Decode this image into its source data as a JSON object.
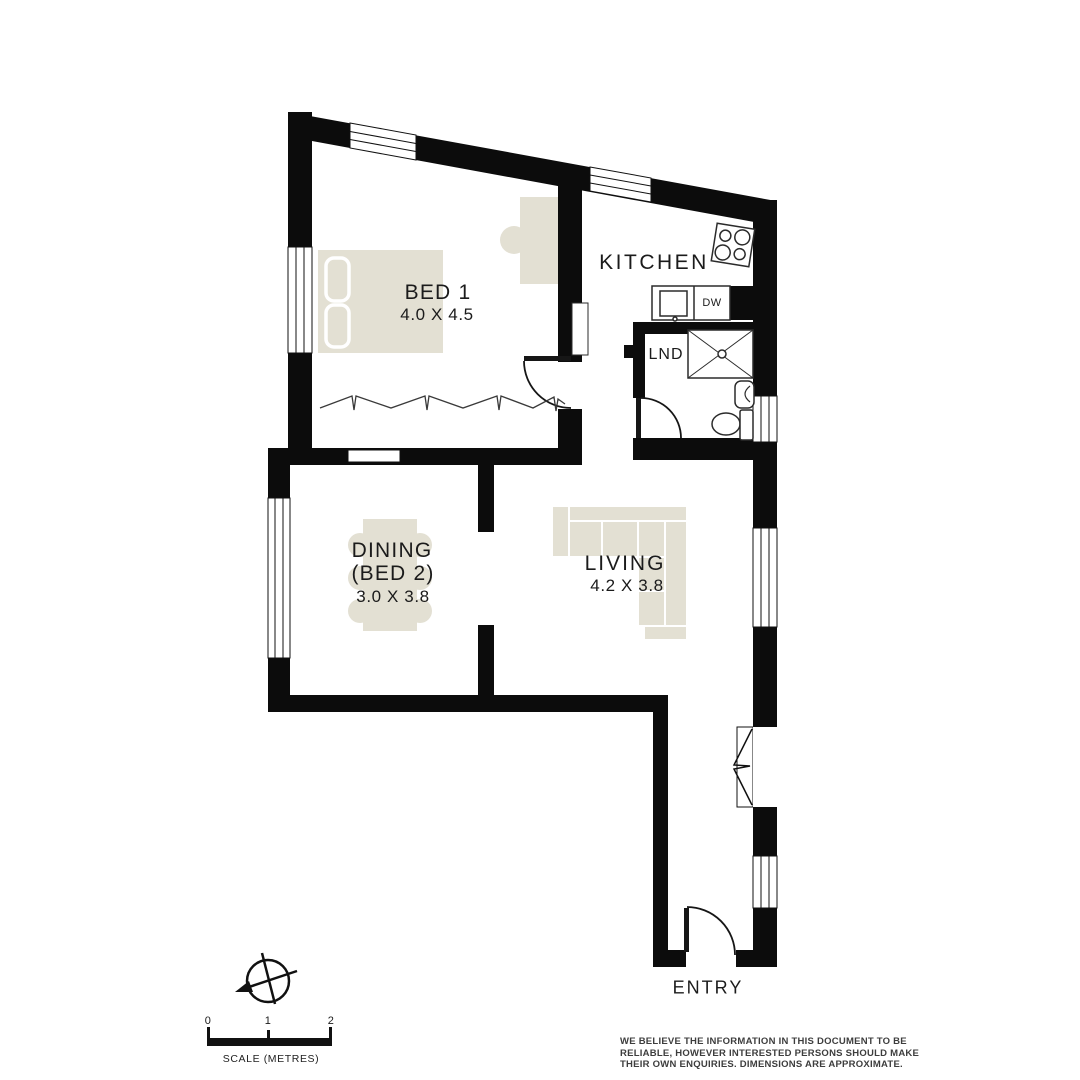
{
  "rooms": {
    "bed1": {
      "label": "BED 1",
      "dims": "4.0 X 4.5"
    },
    "kitchen": {
      "label": "KITCHEN"
    },
    "laundry": {
      "label": "LND"
    },
    "dining": {
      "label": "DINING",
      "alt_label": "(BED 2)",
      "dims": "3.0 X 3.8"
    },
    "living": {
      "label": "LIVING",
      "dims": "4.2 X 3.8"
    },
    "entry": {
      "label": "ENTRY"
    }
  },
  "appliances": {
    "dishwasher_label": "DW"
  },
  "scale_bar": {
    "tick0": "0",
    "tick1": "1",
    "tick2": "2",
    "label": "SCALE (METRES)"
  },
  "compass": {
    "icon": "north-arrow"
  },
  "disclaimer": {
    "line1": "WE BELIEVE THE INFORMATION IN THIS DOCUMENT TO BE",
    "line2": "RELIABLE, HOWEVER INTERESTED PERSONS SHOULD MAKE",
    "line3": "THEIR OWN ENQUIRIES. DIMENSIONS ARE APPROXIMATE."
  },
  "colors": {
    "wall": "#0c0c0c",
    "furniture": "#e3e0d3",
    "background": "#ffffff",
    "text": "#1b1b1b"
  }
}
